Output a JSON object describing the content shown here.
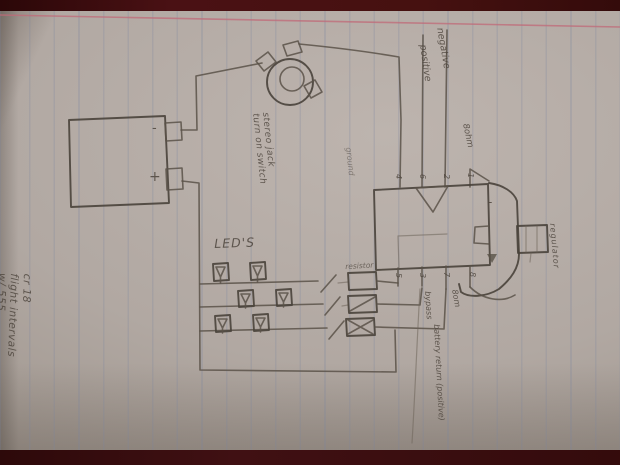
{
  "scene": {
    "description": "hand-drawn LED / 555 timer circuit sketch on lined notebook paper photographed on a dark maroon surface",
    "surface_color": "#3a0c0e",
    "paper_color": "#b1a8a2",
    "pencil_color": "#5a5249",
    "margin_rule_color": "#c06a78"
  },
  "battery": {
    "minus": "-",
    "plus": "+"
  },
  "jack_note": {
    "line1": "stereo jack",
    "line2": "turn on switch"
  },
  "wires": {
    "negative": "negative",
    "positive": "positive",
    "ground": "ground"
  },
  "ic": {
    "pins_top": [
      "4",
      "6",
      "2",
      "1"
    ],
    "pins_bottom": [
      "5",
      "3",
      "7",
      "8"
    ]
  },
  "leds": {
    "title": "LED'S"
  },
  "resistors": {
    "label": "resistor"
  },
  "speaker": {
    "minus": "-",
    "impedance_top": "8ohm",
    "impedance_bottom": "8om"
  },
  "notes": {
    "bypass": "bypass",
    "battery_return": "battery return (positive)",
    "regulator": "regulator"
  },
  "margin_note": {
    "line1": "cr 18",
    "line2": "flight intervals",
    "line3": "w/ 555"
  }
}
